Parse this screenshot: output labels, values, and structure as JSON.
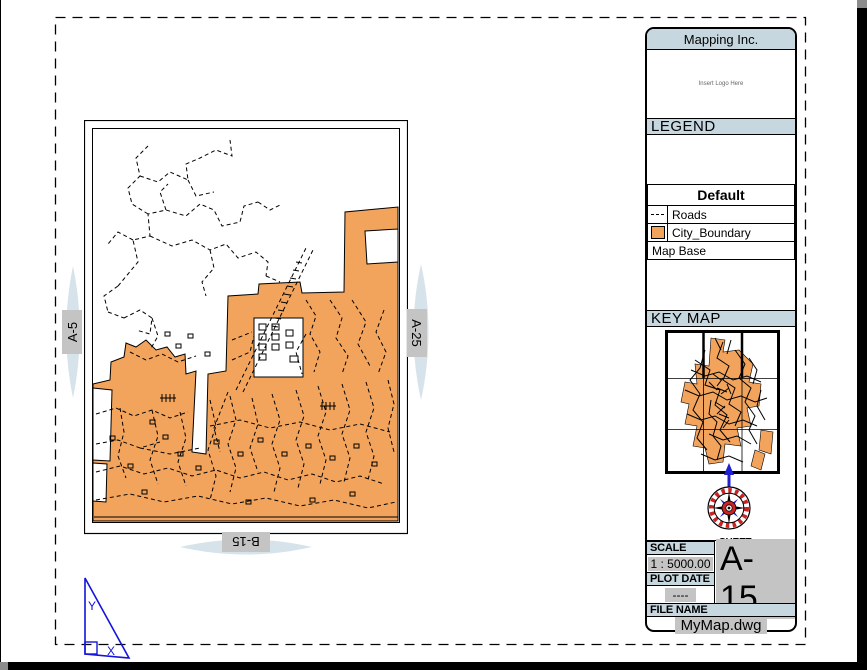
{
  "colors": {
    "city_boundary_orange": "#f3a45c",
    "header_band_blue": "#c7d7df",
    "matchline_lens_blue": "#d6e3ea",
    "field_highlight_gray": "#c4c4c4",
    "compass_red": "#cc2222",
    "compass_blue": "#2020d0",
    "ucs_blue": "#1414dc"
  },
  "title_block": {
    "company": "Mapping Inc.",
    "logo_placeholder": "Insert Logo Here",
    "legend": {
      "title": "LEGEND",
      "group_header": "Default",
      "items": [
        {
          "symbol": "dashed-line",
          "label": "Roads"
        },
        {
          "symbol": "orange-swatch",
          "label": "City_Boundary"
        }
      ],
      "base_row": "Map Base"
    },
    "key_map_title": "KEY MAP",
    "scale_label": "SCALE",
    "scale_value": "1 : 5000.00",
    "sheet_number_label": "SHEET NUMBER",
    "sheet_number_value": "A-15",
    "plot_date_label": "PLOT DATE",
    "plot_date_value": "----",
    "file_name_label": "FILE NAME",
    "file_name_value": "MyMap.dwg"
  },
  "match_lines": {
    "left": "A-5",
    "right": "A-25",
    "bottom": "B-15"
  },
  "ucs_icon": {
    "x_label": "X",
    "y_label": "Y"
  }
}
